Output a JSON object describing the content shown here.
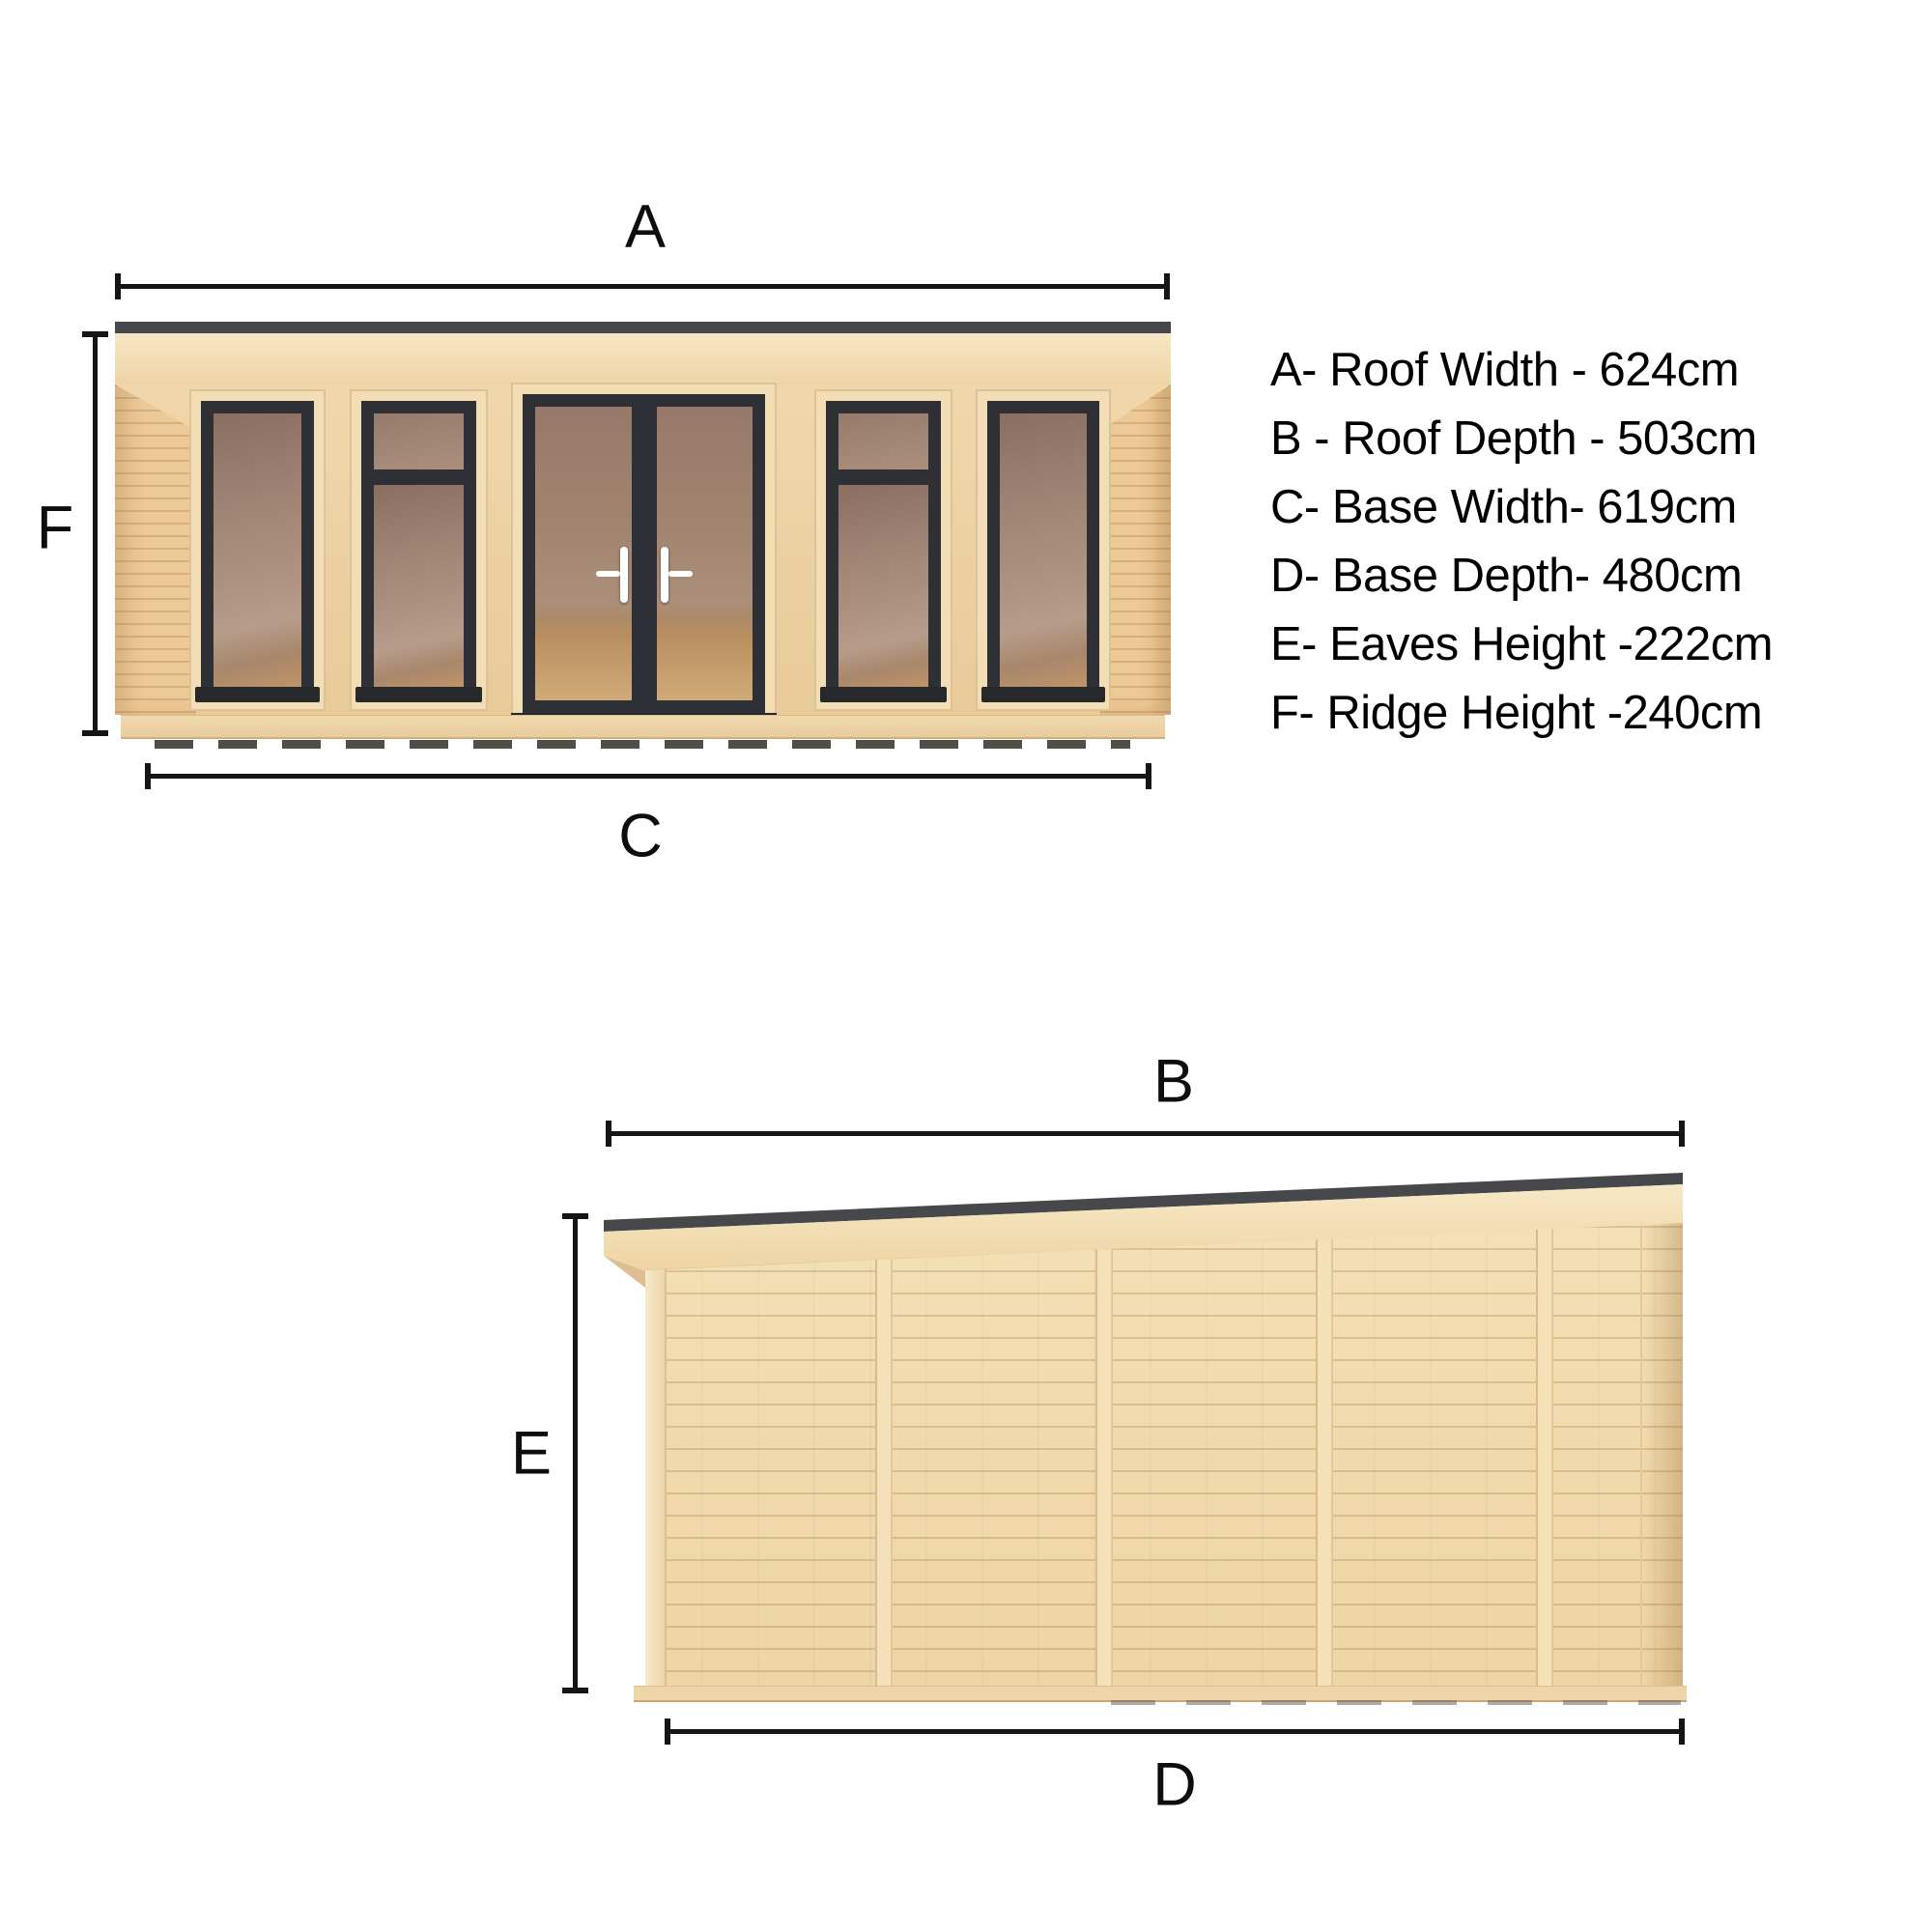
{
  "front_view": {
    "description": "Front elevation of garden room with five glazed bays",
    "labels": {
      "roof_width": "A",
      "ridge_height": "F",
      "base_width": "C"
    }
  },
  "side_view": {
    "description": "Side elevation with mono-pitch pent roof and five cladding bays",
    "labels": {
      "roof_depth": "B",
      "eaves_height": "E",
      "base_depth": "D"
    }
  },
  "legend": {
    "items": [
      {
        "key": "A",
        "name": "Roof Width",
        "value_cm": 624,
        "text": "A- Roof Width - 624cm"
      },
      {
        "key": "B",
        "name": "Roof Depth",
        "value_cm": 503,
        "text": "B - Roof Depth - 503cm"
      },
      {
        "key": "C",
        "name": "Base Width",
        "value_cm": 619,
        "text": "C- Base Width- 619cm"
      },
      {
        "key": "D",
        "name": "Base Depth",
        "value_cm": 480,
        "text": "D- Base Depth- 480cm"
      },
      {
        "key": "E",
        "name": "Eaves Height",
        "value_cm": 222,
        "text": "E- Eaves Height -222cm"
      },
      {
        "key": "F",
        "name": "Ridge Height",
        "value_cm": 240,
        "text": "F- Ridge Height -240cm"
      }
    ]
  },
  "colors": {
    "background": "#ffffff",
    "dimension_line": "#151515",
    "roof_strip": "#47484c",
    "frame_dark": "#2e3035",
    "wood_fascia": "#f2ddb2",
    "wood_cladding": "#ecd0a2",
    "glass_interior": "#a8897a",
    "floor_wood": "#c9a06b"
  }
}
